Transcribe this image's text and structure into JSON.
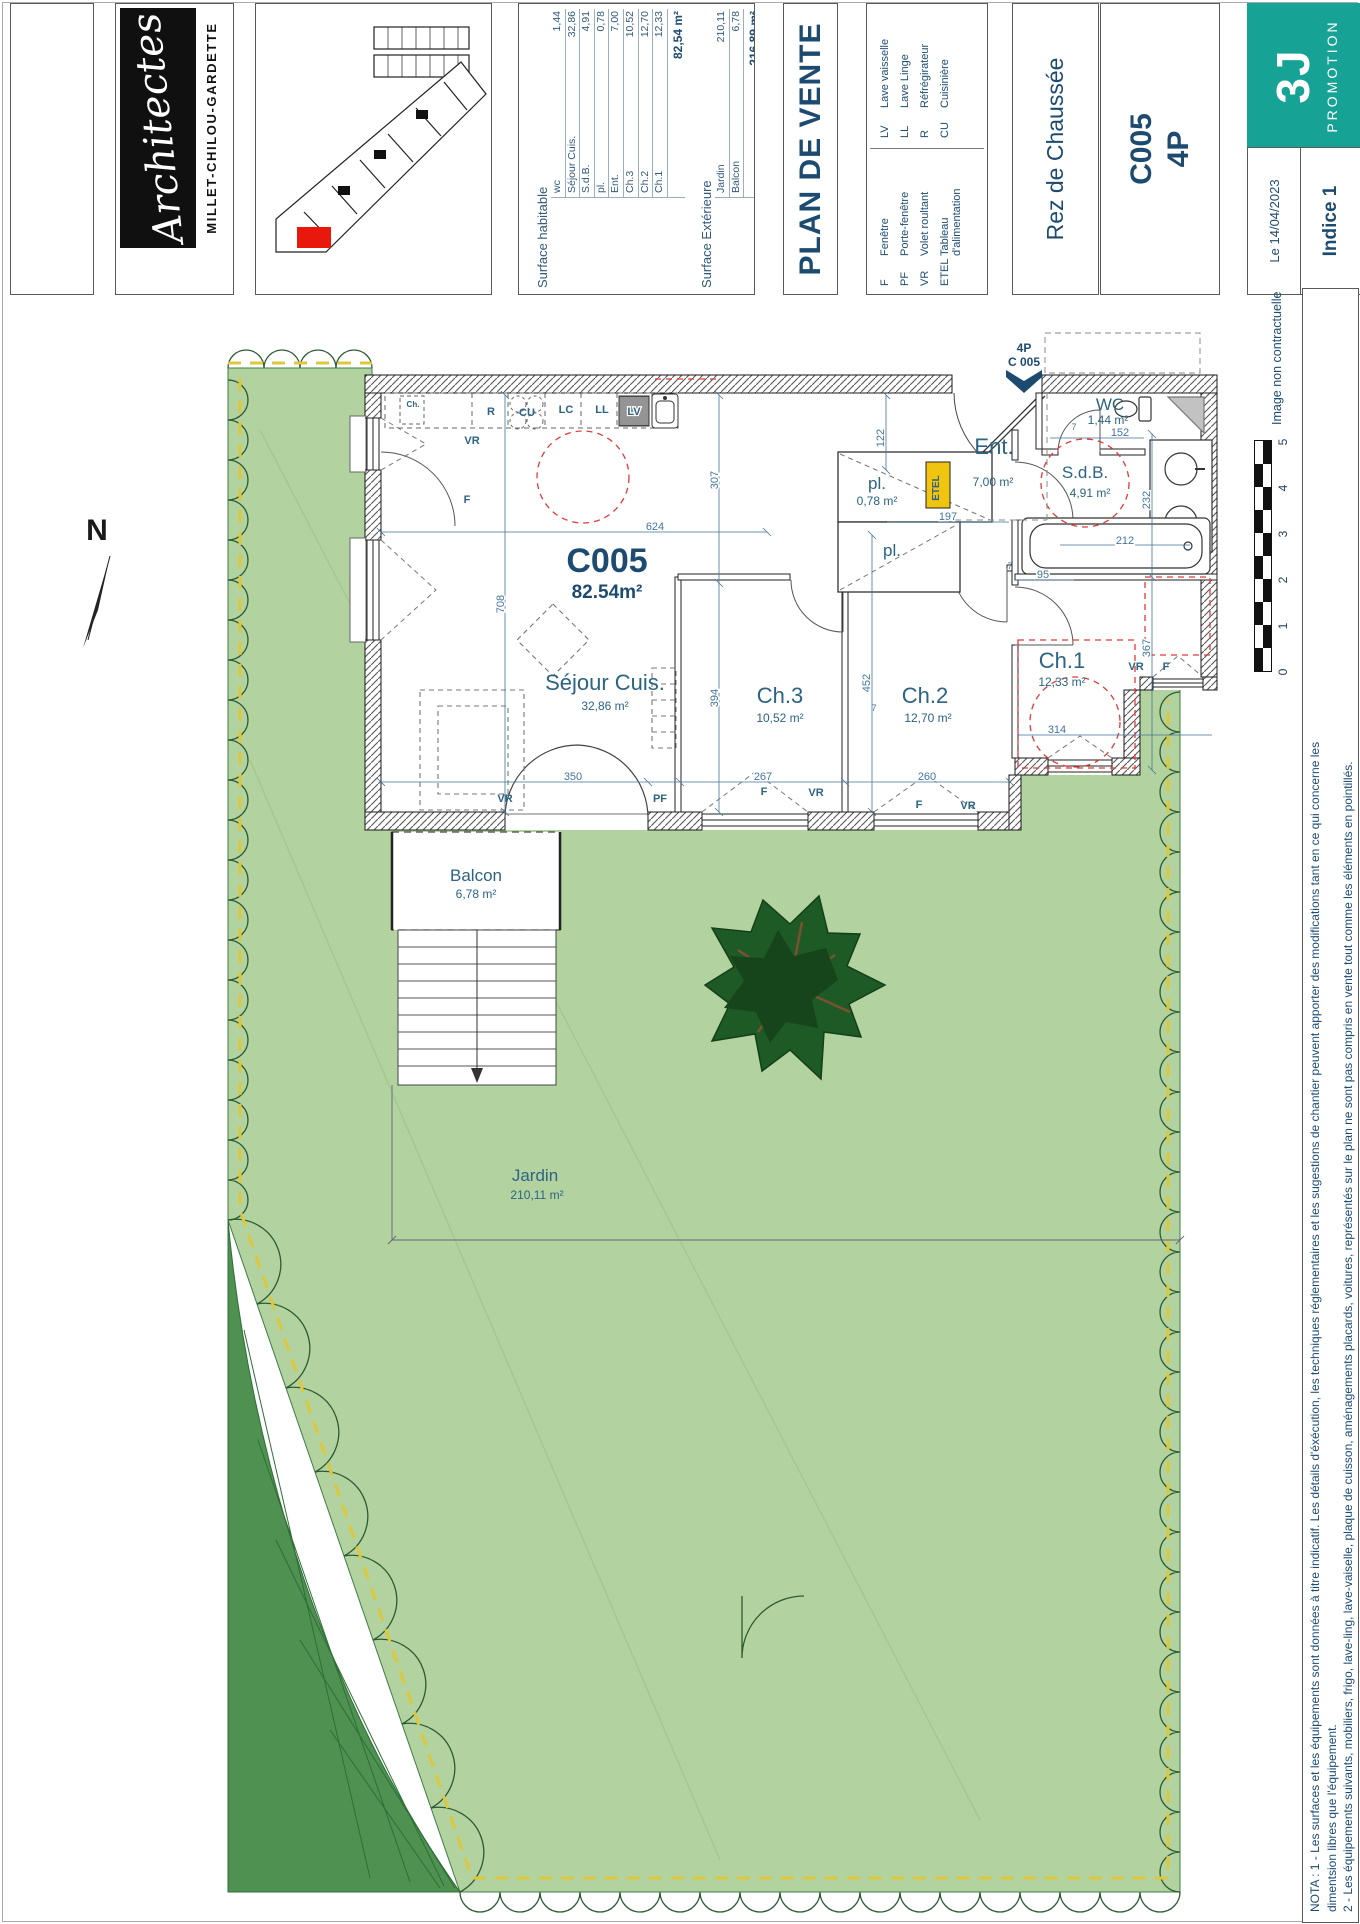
{
  "colors": {
    "navy": "#1d4b70",
    "label_blue": "#2d6383",
    "dim_blue": "#44749c",
    "teal": "#16a295",
    "garden": "#b2d3a0",
    "talus": "#4e9150",
    "tree": "#1e5a25",
    "red_dash": "#e03a3a",
    "yellow_dash": "#ddc83d",
    "etel_yellow": "#f1c40f"
  },
  "titlebar": {
    "architects": {
      "script": "Architectes",
      "firm": "MILLET-CHILOU-GARDETTE"
    },
    "surface_table": {
      "habitable_header": "Surface habitable",
      "habitable_rows": [
        [
          "wc",
          "1,44"
        ],
        [
          "Séjour Cuis.",
          "32,86"
        ],
        [
          "S.d.B.",
          "4,91"
        ],
        [
          "pl.",
          "0,78"
        ],
        [
          "Ent.",
          "7,00"
        ],
        [
          "Ch.3",
          "10,52"
        ],
        [
          "Ch.2",
          "12,70"
        ],
        [
          "Ch.1",
          "12,33"
        ]
      ],
      "habitable_total": "82,54 m²",
      "exterior_header": "Surface Extérieure",
      "exterior_rows": [
        [
          "Jardin",
          "210,11"
        ],
        [
          "Balcon",
          "6,78"
        ]
      ],
      "exterior_total": "216,89 m²"
    },
    "plan_title": "PLAN DE VENTE",
    "legend": {
      "col1": [
        [
          "F",
          "Fenêtre"
        ],
        [
          "PF",
          "Porte-fenêtre"
        ],
        [
          "VR",
          "Volet roultant"
        ],
        [
          "ETEL",
          "Tableau d'alimentation"
        ]
      ],
      "col2": [
        [
          "LV",
          "Lave vaisselle"
        ],
        [
          "LL",
          "Lave Linge"
        ],
        [
          "R",
          "Réfrégirateur"
        ],
        [
          "CU",
          "Cuisinière"
        ]
      ]
    },
    "level": "Rez de Chaussée",
    "unit_code": "C005",
    "unit_type": "4P",
    "promoter": {
      "mark": "3J",
      "name": "PROMOTION"
    },
    "date": "Le 14/04/2023",
    "indice": "Indice 1"
  },
  "margin": {
    "disclaimer": "Image non contractuelle",
    "scale_ticks": [
      "0",
      "1",
      "2",
      "3",
      "4",
      "5"
    ],
    "nota_lines": [
      "NOTA : 1 - Les surfaces et les équipements sont données à titre indicatif. Les détails d'éxécution, les techniques réglementaires et les sugestions de chantier peuvent apporter des modifications tant  en ce qui concerne les",
      "dimentsion libres que l'équipement.",
      "2 - Les équipements suivants, mobiliers, frigo, lave-ling, lave-vaiselle, plaque de cuisson, aménagements placards, voitures, représentés sur le plan ne sont pas compris en vente tout comme les éléments en pointillés."
    ]
  },
  "plan": {
    "north": "N",
    "entrance": {
      "line1": "4P",
      "line2": "C 005"
    },
    "unit_label": "C005",
    "unit_area": "82.54m²",
    "rooms": {
      "sejour": {
        "name": "Séjour Cuis.",
        "area": "32,86 m²"
      },
      "ch3": {
        "name": "Ch.3",
        "area": "10,52 m²"
      },
      "ch2": {
        "name": "Ch.2",
        "area": "12,70 m²"
      },
      "ch1": {
        "name": "Ch.1",
        "area": "12,33 m²"
      },
      "sdb": {
        "name": "S.d.B.",
        "area": "4,91 m²"
      },
      "wc": {
        "name": "WC",
        "area": "1,44 m²"
      },
      "ent": {
        "name": "Ent.",
        "area": "7,00 m²"
      },
      "pl1": {
        "name": "pl.",
        "area": "0,78 m²"
      },
      "pl2": {
        "name": "pl."
      },
      "balcon": {
        "name": "Balcon",
        "area": "6,78 m²"
      },
      "jardin": {
        "name": "Jardin",
        "area": "210,11 m²"
      }
    },
    "kitchen": {
      "ch": "Ch.",
      "r": "R",
      "cu": "CU",
      "lc": "LC",
      "ll": "LL",
      "lv": "LV",
      "etel": "ETEL"
    },
    "openings": [
      "VR",
      "F",
      "VR",
      "PF",
      "F",
      "VR",
      "F",
      "VR",
      "VR",
      "F"
    ],
    "dims": [
      "708",
      "624",
      "307",
      "394",
      "122",
      "452",
      "232",
      "367",
      "350",
      "267",
      "260",
      "314",
      "95",
      "197",
      "152",
      "212",
      "7",
      "7",
      "7"
    ]
  }
}
